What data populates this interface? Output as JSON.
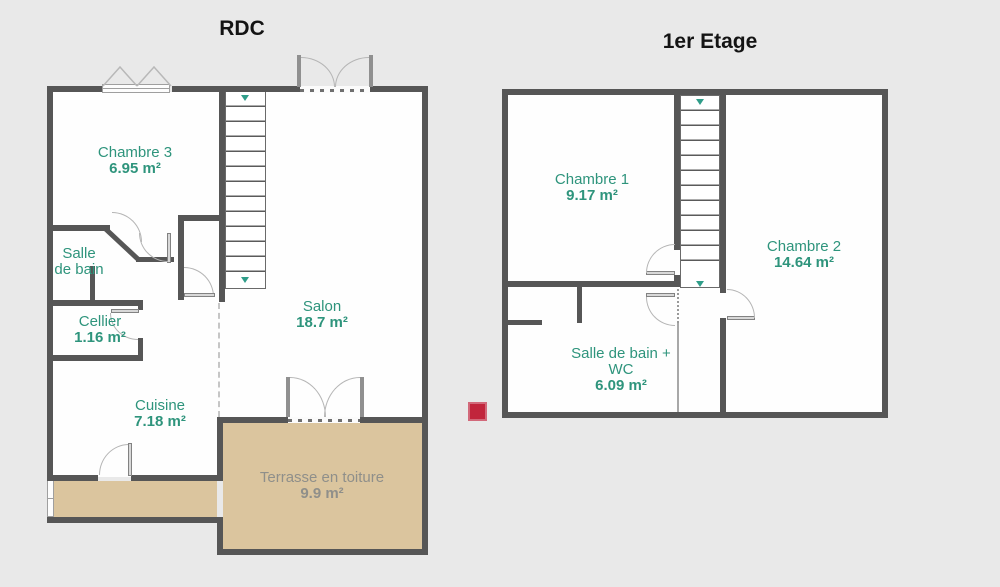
{
  "palette": {
    "background": "#e9e9e9",
    "wall": "#565656",
    "room_fill": "#fefefe",
    "room_label": "#2e947c",
    "terrace_fill": "#dbc59e",
    "terrace_label": "#8f8f8a",
    "stair_arrow": "#2f9d89",
    "marker_red": "#c1253c"
  },
  "marker": {
    "color": "#c1253c"
  },
  "floors": {
    "rdc": {
      "title": "RDC",
      "rooms": {
        "chambre3": {
          "name": "Chambre 3",
          "area": "6.95 m²"
        },
        "salle_de_bain": {
          "name": "Salle de bain"
        },
        "cellier": {
          "name": "Cellier",
          "area": "1.16 m²"
        },
        "salon": {
          "name": "Salon",
          "area": "18.7 m²"
        },
        "cuisine": {
          "name": "Cuisine",
          "area": "7.18 m²"
        },
        "terrasse": {
          "name": "Terrasse en toiture",
          "area": "9.9 m²"
        }
      }
    },
    "etage1": {
      "title": "1er Etage",
      "rooms": {
        "chambre1": {
          "name": "Chambre 1",
          "area": "9.17 m²"
        },
        "chambre2": {
          "name": "Chambre 2",
          "area": "14.64 m²"
        },
        "salle_de_bain_wc": {
          "name": "Salle de bain + WC",
          "area": "6.09 m²"
        }
      }
    }
  }
}
